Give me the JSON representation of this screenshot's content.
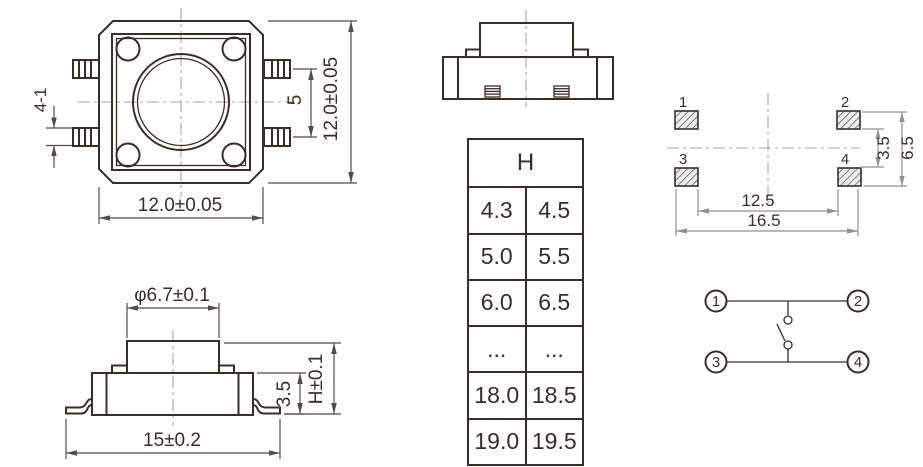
{
  "drawing": {
    "top_view": {
      "lead_dim": "4-1",
      "pitch_dim": "5",
      "height_dim": "12.0±0.05",
      "width_dim": "12.0±0.05"
    },
    "front_view": {
      "knob_dim": "φ6.7±0.1",
      "body_height_dim": "3.5",
      "total_height_dim": "H±0.1",
      "width_dim": "15±0.2"
    },
    "pad_layout": {
      "pin_labels": [
        "1",
        "2",
        "3",
        "4"
      ],
      "row_inner_dim": "3.5",
      "row_outer_dim": "6.5",
      "col_inner_dim": "12.5",
      "col_outer_dim": "16.5"
    },
    "circuit": {
      "pin_labels": [
        "1",
        "2",
        "3",
        "4"
      ]
    },
    "height_table": {
      "header": "H",
      "rows": [
        [
          "4.3",
          "4.5"
        ],
        [
          "5.0",
          "5.5"
        ],
        [
          "6.0",
          "6.5"
        ],
        [
          "...",
          "..."
        ],
        [
          "18.0",
          "18.5"
        ],
        [
          "19.0",
          "19.5"
        ]
      ]
    }
  }
}
